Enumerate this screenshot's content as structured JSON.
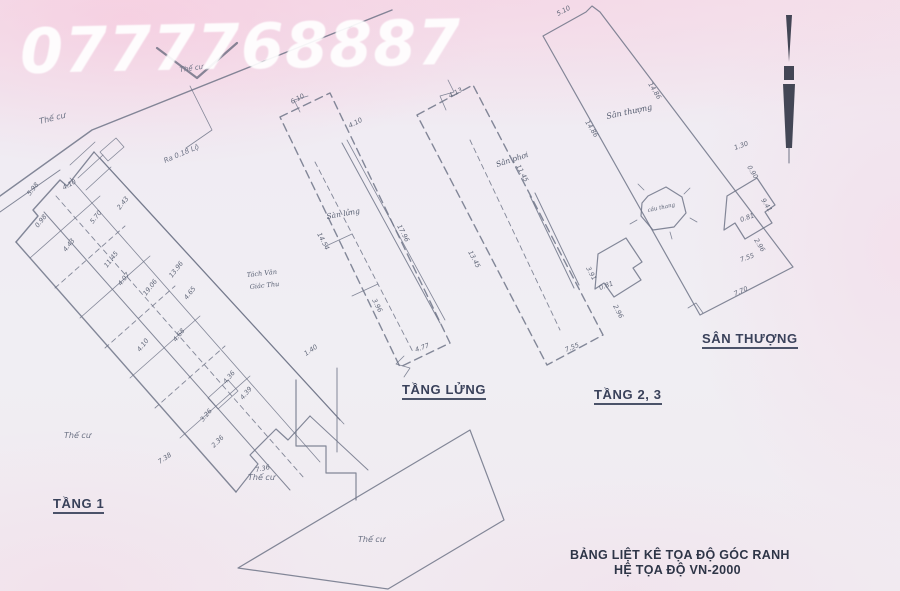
{
  "watermark": {
    "phone": "0777768887"
  },
  "plans": {
    "tang1": {
      "label": "TẦNG 1",
      "street_note": "Ra 0.18 Lộ",
      "neighbor_note_line1": "Tách Văn",
      "neighbor_note_line2": "Giác Thu",
      "dims": [
        "5.98",
        "0.98",
        "4.43",
        "5.70",
        "2.43",
        "4.10",
        "11.45",
        "4.07",
        "19.06",
        "13.96",
        "4.65",
        "4.68",
        "4.10",
        "1.40",
        "4.36",
        "4.39",
        "3.26",
        "2.36",
        "7.38",
        "7.36"
      ]
    },
    "tang_lung": {
      "label": "TẦNG LỬNG",
      "inner_label": "Sàn lửng",
      "dims": [
        "6.10",
        "4.10",
        "14.54",
        "17.96",
        "3.96",
        "4.77"
      ]
    },
    "tang_2_3": {
      "label": "TẦNG 2, 3",
      "inner_label": "Sân phơi",
      "dims": [
        "4.13",
        "11.45",
        "13.45",
        "3.91",
        "0.81",
        "2.96",
        "7.55"
      ]
    },
    "san_thuong": {
      "label": "SÂN THƯỢNG",
      "inner_label": "Sân thượng",
      "stair_label": "cầu thang",
      "dims": [
        "5.10",
        "14.86",
        "14.86",
        "1.30",
        "0.90",
        "9.41",
        "0.81",
        "2.96",
        "7.55",
        "7.70"
      ]
    }
  },
  "land_notes": [
    "Thế cư",
    "Thế cư",
    "Thế cư",
    "Thế cư",
    "Thế cư"
  ],
  "footer": {
    "line1": "BẢNG LIỆT KÊ TỌA ĐỘ GÓC RANH",
    "line2": "HỆ TỌA ĐỘ VN-2000"
  },
  "colors": {
    "line": "#6e7487",
    "label": "#39415a",
    "watermark": "#ffffff"
  }
}
